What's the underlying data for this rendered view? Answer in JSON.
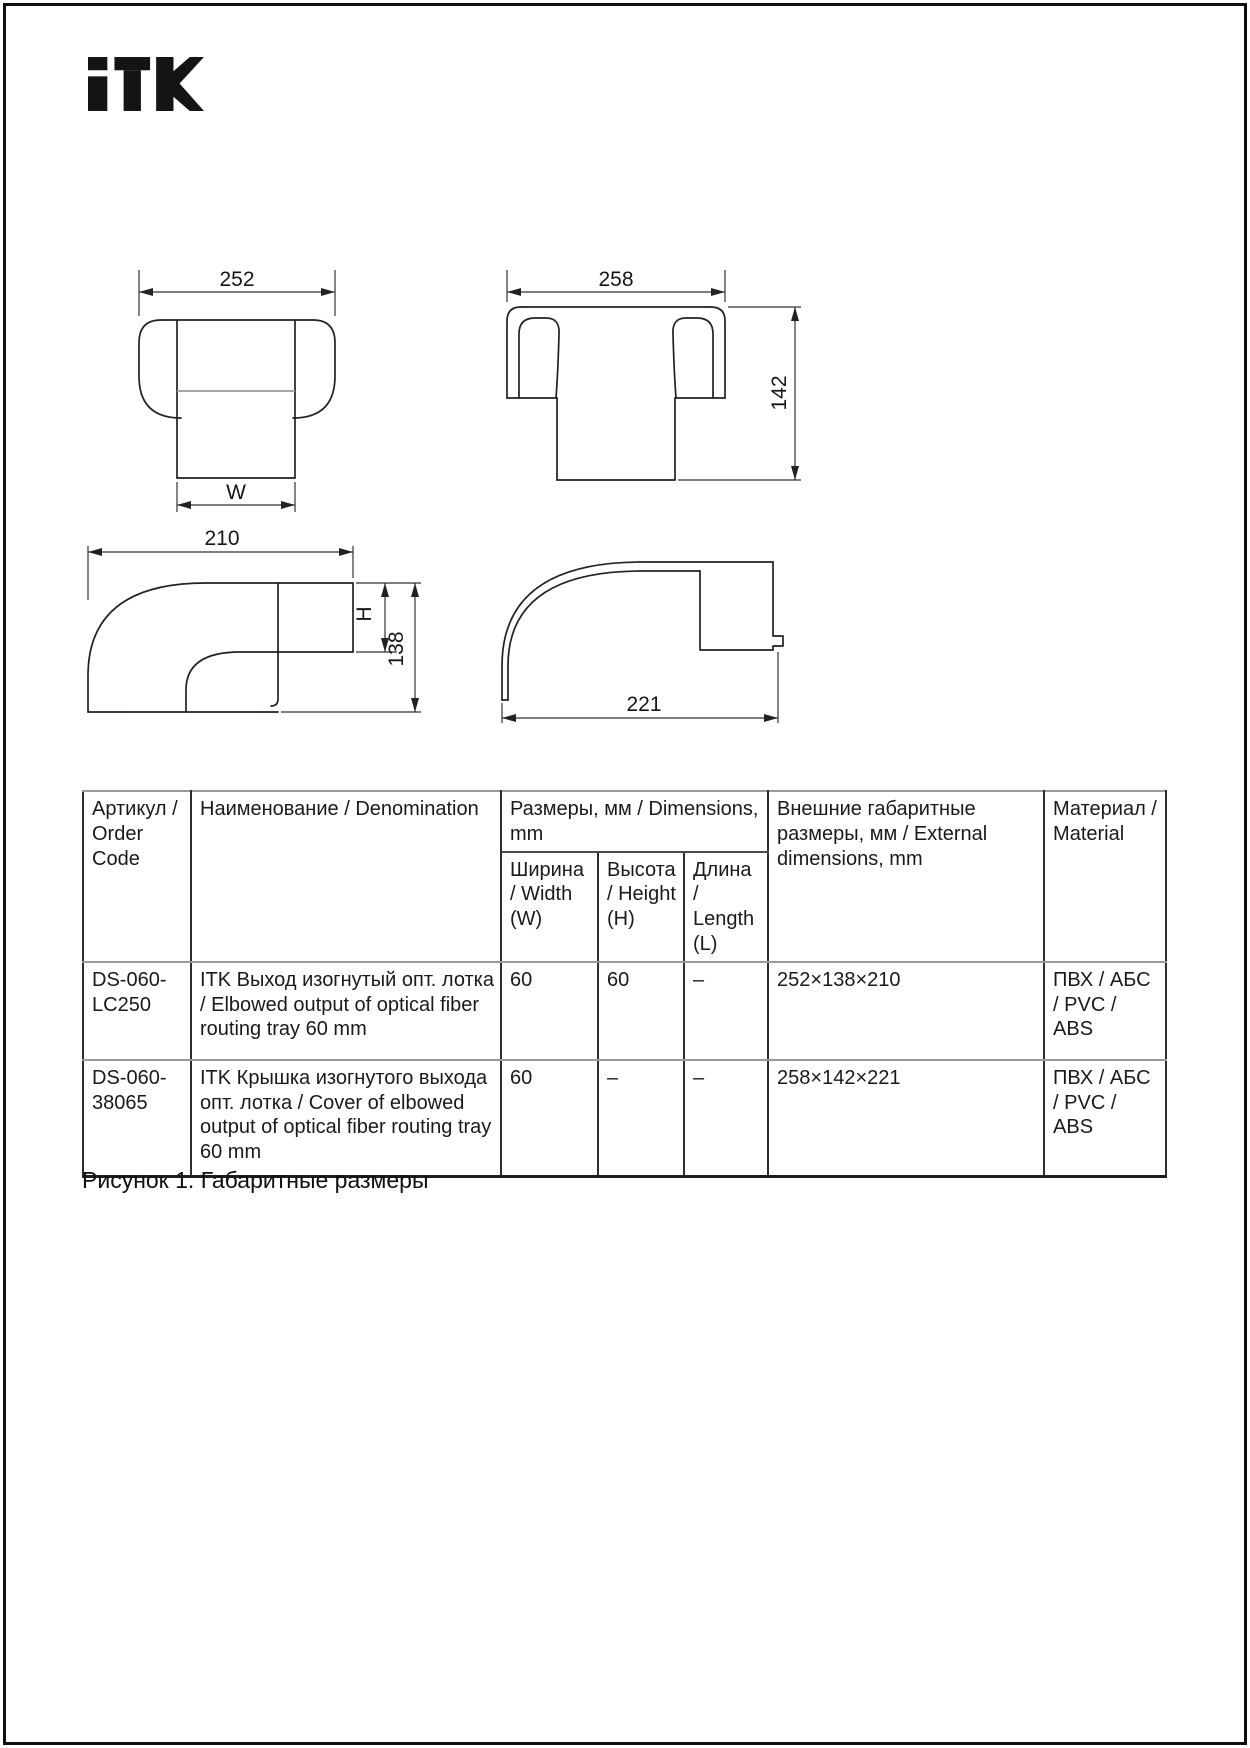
{
  "page": {
    "brand": "ITK",
    "caption": "Рисунок 1. Габаритные размеры"
  },
  "drawings": {
    "elbow_front": {
      "width_dim": "252",
      "w_label": "W"
    },
    "cover_front": {
      "width_dim": "258",
      "height_dim": "142"
    },
    "elbow_side": {
      "length_dim": "210",
      "h_label": "H",
      "height_dim": "138"
    },
    "cover_side": {
      "length_dim": "221"
    }
  },
  "table": {
    "headers": {
      "order_code": "Артикул / Order Code",
      "denomination": "Наименование / Denomination",
      "dimensions_group": "Размеры, мм / Dimensions, mm",
      "width": "Ширина / Width (W)",
      "height": "Высота / Height (H)",
      "length": "Длина / Length (L)",
      "external": "Внешние габаритные размеры, мм / External dimensions, mm",
      "material": "Материал / Material"
    },
    "rows": [
      {
        "code": "DS-060-LC250",
        "denomination": "ITK Выход изогнутый опт. лотка / Elbowed output of optical fiber routing tray  60 mm",
        "width": "60",
        "height": "60",
        "length": "–",
        "external": "252×138×210",
        "material": "ПВХ / АБС / PVC / ABS"
      },
      {
        "code": "DS-060-38065",
        "denomination": "ITK Крышка изогнутого выхода опт. лотка / Cover of elbowed output of optical fiber routing tray 60 mm",
        "width": "60",
        "height": "–",
        "length": "–",
        "external": "258×142×221",
        "material": "ПВХ / АБС / PVC / ABS"
      }
    ]
  }
}
